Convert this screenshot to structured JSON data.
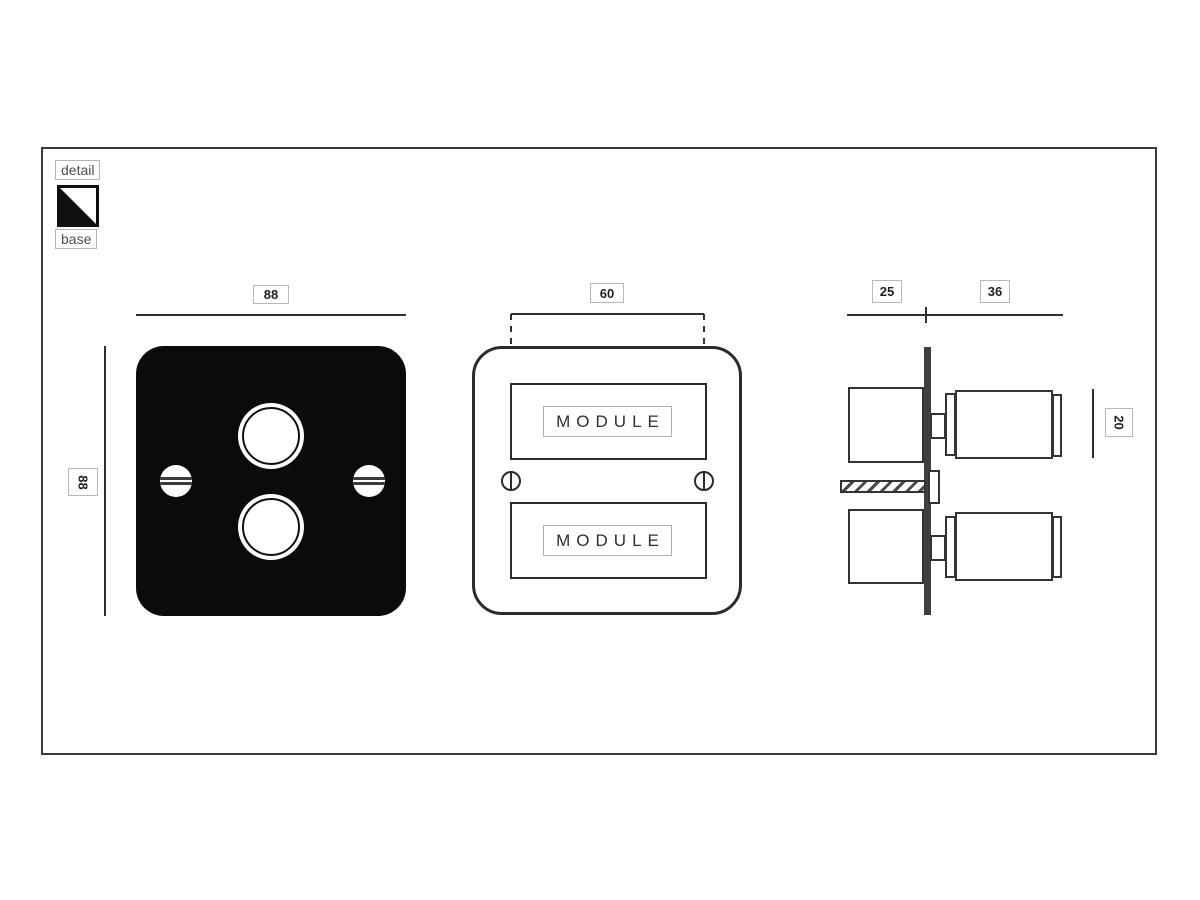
{
  "drawing": {
    "legend": {
      "detail": "detail",
      "base": "base"
    },
    "front_view": {
      "width_label": "88",
      "height_label": "88"
    },
    "detail_view": {
      "module_width_label": "60",
      "modules": [
        "MODULE",
        "MODULE"
      ]
    },
    "side_view": {
      "back_depth_label": "25",
      "front_depth_label": "36",
      "knob_height_label": "20"
    }
  },
  "colors": {
    "line": "#303030",
    "plate_black": "#0b0b0b",
    "plate_bar_fill": "#3f3f3f",
    "label_border": "#b8b8b8",
    "label_text": "#1f1f28",
    "annotation_text": "#4f4f4f"
  }
}
